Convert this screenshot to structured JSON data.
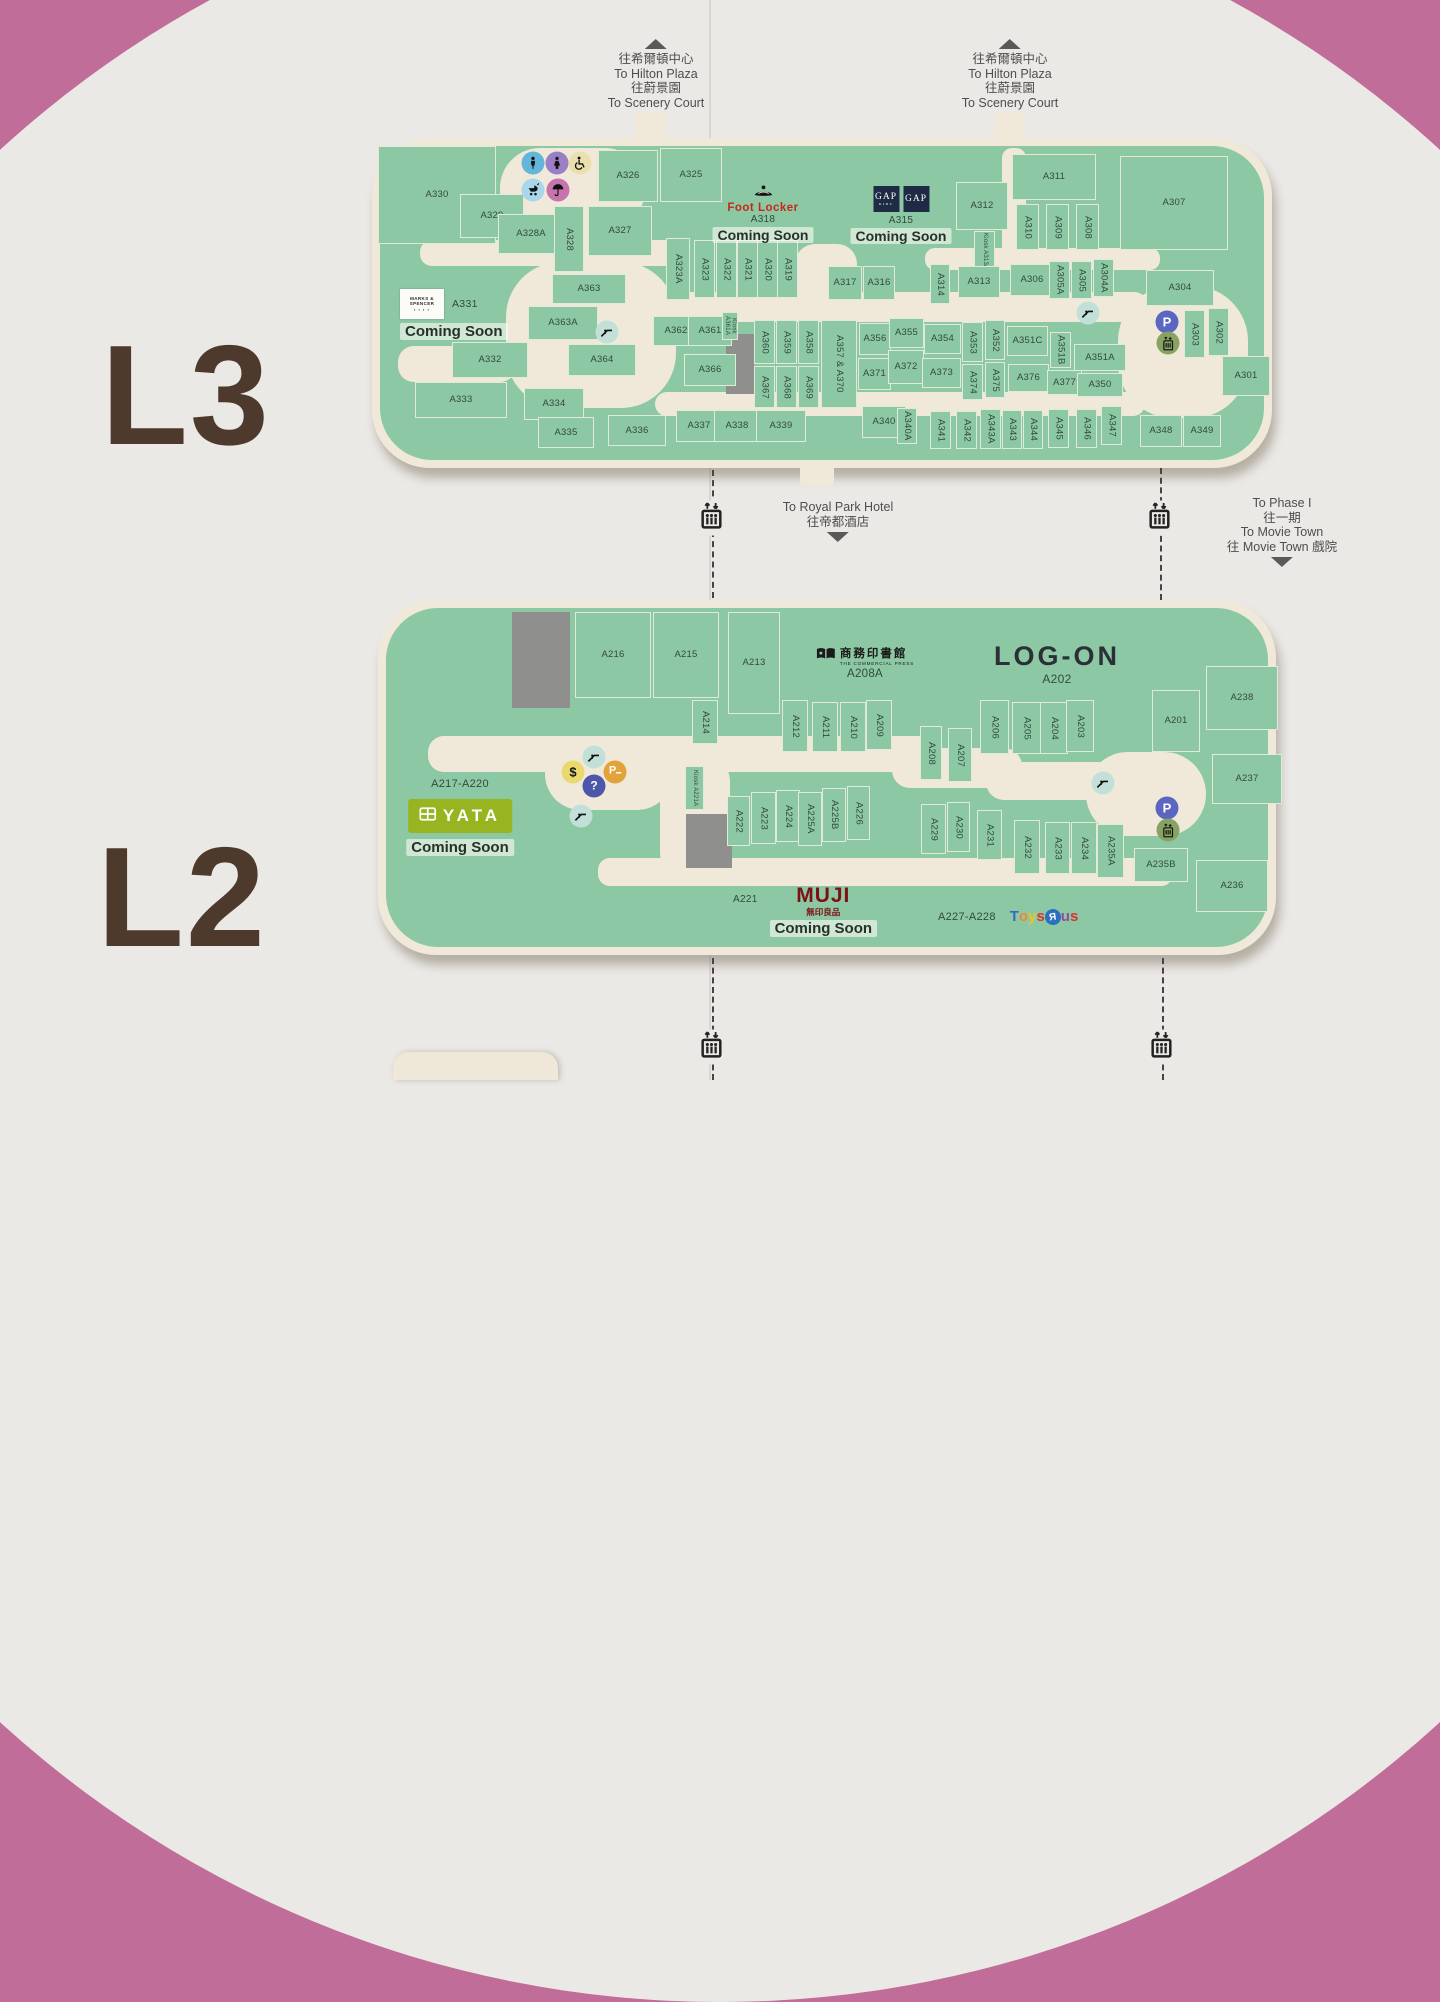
{
  "colors": {
    "pink": "#c16d99",
    "panel": "#ebe9e6",
    "map_base": "#f0e9da",
    "map_green": "#8dc8a4",
    "gray_block": "#8f8f8d",
    "floor_letter": "#4e3a2c",
    "unit_text": "#31493c"
  },
  "icon_colors": {
    "toilet-male": "#64b6d9",
    "toilet-female": "#9a7fc6",
    "accessible": "#ecdfae",
    "stroller": "#a9d6ea",
    "nursing": "#c673ae",
    "escalator": "#c2e0d8",
    "parking": "#5a66bf",
    "lift": "#87a262",
    "dollar": "#e9d96f",
    "meter": "#e2a33b",
    "info": "#4d57a9"
  },
  "floor_labels": [
    {
      "text": "L3",
      "x": 186,
      "y": 396
    },
    {
      "text": "L2",
      "x": 182,
      "y": 898
    }
  ],
  "signs": [
    {
      "id": "hilton-plaza-left",
      "x": 656,
      "y": 36,
      "dir": "up",
      "lines": [
        "往希爾頓中心",
        "To Hilton Plaza",
        "往蔚景園",
        "To Scenery Court"
      ]
    },
    {
      "id": "hilton-plaza-right",
      "x": 1010,
      "y": 36,
      "dir": "up",
      "lines": [
        "往希爾頓中心",
        "To Hilton Plaza",
        "往蔚景園",
        "To Scenery Court"
      ]
    },
    {
      "id": "royal-park-hotel",
      "x": 838,
      "y": 500,
      "dir": "down",
      "lines": [
        "To Royal Park Hotel",
        "往帝都酒店"
      ]
    },
    {
      "id": "phase1-movie-town",
      "x": 1282,
      "y": 496,
      "dir": "down",
      "lines": [
        "To Phase I",
        "往一期",
        "To Movie Town",
        "往 Movie Town 戲院"
      ]
    }
  ],
  "connectors": {
    "dashes": [
      [
        712,
        470,
        128
      ],
      [
        1160,
        468,
        132
      ],
      [
        712,
        958,
        122
      ],
      [
        1162,
        958,
        122
      ]
    ],
    "lifts": [
      [
        712,
        518
      ],
      [
        1160,
        518
      ],
      [
        712,
        1047
      ],
      [
        1162,
        1047
      ]
    ]
  },
  "stub": {
    "x": 393,
    "y": 1052,
    "w": 165,
    "h": 28
  },
  "floors": [
    {
      "id": "L3",
      "base": [
        372,
        138,
        900,
        330,
        58
      ],
      "tabs": [
        [
          636,
          112,
          30,
          46
        ],
        [
          994,
          112,
          30,
          46
        ],
        [
          800,
          440,
          34,
          46
        ]
      ],
      "walkways": [
        [
          500,
          148,
          145,
          82,
          40
        ],
        [
          545,
          200,
          48,
          110,
          20
        ],
        [
          506,
          262,
          170,
          146,
          55
        ],
        [
          618,
          292,
          530,
          30,
          14
        ],
        [
          655,
          392,
          490,
          24,
          12
        ],
        [
          1118,
          286,
          130,
          132,
          55
        ],
        [
          925,
          248,
          235,
          22,
          10
        ],
        [
          1002,
          148,
          24,
          112,
          10
        ],
        [
          795,
          244,
          62,
          76,
          20
        ],
        [
          420,
          240,
          260,
          26,
          12
        ],
        [
          398,
          346,
          118,
          36,
          16
        ]
      ],
      "grays": [
        [
          726,
          334,
          28,
          60
        ]
      ],
      "units": [
        [
          "A330",
          378,
          146,
          118,
          98
        ],
        [
          "A329",
          460,
          194,
          64,
          44
        ],
        [
          "A328A",
          498,
          214,
          66,
          40
        ],
        [
          "A328",
          554,
          206,
          30,
          66,
          "v"
        ],
        [
          "A327",
          588,
          206,
          64,
          50
        ],
        [
          "A326",
          598,
          150,
          60,
          52
        ],
        [
          "A325",
          660,
          148,
          62,
          54
        ],
        [
          "A323A",
          666,
          238,
          24,
          62,
          "v"
        ],
        [
          "A323",
          694,
          240,
          21,
          58,
          "v"
        ],
        [
          "A322",
          716,
          240,
          21,
          58,
          "v"
        ],
        [
          "A321",
          737,
          240,
          21,
          58,
          "v"
        ],
        [
          "A320",
          757,
          240,
          21,
          58,
          "v"
        ],
        [
          "A319",
          777,
          240,
          21,
          58,
          "v"
        ],
        [
          "A317",
          828,
          266,
          34,
          34
        ],
        [
          "A316",
          863,
          266,
          32,
          34
        ],
        [
          "A311",
          1012,
          154,
          84,
          46
        ],
        [
          "A312",
          956,
          182,
          52,
          48
        ],
        [
          "A310",
          1016,
          204,
          23,
          46,
          "v"
        ],
        [
          "A309",
          1046,
          204,
          23,
          46,
          "v"
        ],
        [
          "A308",
          1076,
          204,
          23,
          46,
          "v"
        ],
        [
          "A307",
          1120,
          156,
          108,
          94
        ],
        [
          "Kiosk A313A",
          974,
          231,
          21,
          40,
          "vs"
        ],
        [
          "A313",
          958,
          266,
          42,
          32
        ],
        [
          "A314",
          930,
          264,
          20,
          40,
          "v"
        ],
        [
          "A306",
          1010,
          264,
          44,
          32
        ],
        [
          "A305A",
          1049,
          261,
          21,
          38,
          "v"
        ],
        [
          "A305",
          1071,
          261,
          21,
          38,
          "v"
        ],
        [
          "A304A",
          1093,
          259,
          21,
          38,
          "v"
        ],
        [
          "A304",
          1146,
          270,
          68,
          36
        ],
        [
          "A303",
          1184,
          310,
          21,
          48,
          "v"
        ],
        [
          "A302",
          1208,
          308,
          21,
          48,
          "v"
        ],
        [
          "A301",
          1222,
          356,
          48,
          40
        ],
        [
          "A363",
          552,
          274,
          74,
          30
        ],
        [
          "A363A",
          528,
          306,
          70,
          34
        ],
        [
          "A364",
          568,
          344,
          68,
          32
        ],
        [
          "A332",
          452,
          342,
          76,
          36
        ],
        [
          "A333",
          415,
          382,
          92,
          36
        ],
        [
          "A334",
          524,
          388,
          60,
          32
        ],
        [
          "A335",
          538,
          417,
          56,
          31
        ],
        [
          "A336",
          608,
          415,
          58,
          31
        ],
        [
          "A362",
          653,
          316,
          46,
          30
        ],
        [
          "A361",
          688,
          316,
          44,
          30
        ],
        [
          "Kiosk A361A",
          722,
          312,
          16,
          28,
          "vs"
        ],
        [
          "A366",
          684,
          354,
          52,
          32
        ],
        [
          "A337",
          676,
          410,
          46,
          32
        ],
        [
          "A338",
          714,
          410,
          46,
          32
        ],
        [
          "A339",
          756,
          410,
          50,
          32
        ],
        [
          "A360",
          754,
          320,
          21,
          44,
          "v"
        ],
        [
          "A359",
          776,
          320,
          21,
          44,
          "v"
        ],
        [
          "A358",
          798,
          320,
          21,
          44,
          "v"
        ],
        [
          "A367",
          754,
          366,
          21,
          42,
          "v"
        ],
        [
          "A368",
          776,
          366,
          21,
          42,
          "v"
        ],
        [
          "A369",
          798,
          366,
          21,
          42,
          "v"
        ],
        [
          "A357 & A370",
          821,
          320,
          36,
          88,
          "v"
        ],
        [
          "A356",
          859,
          323,
          32,
          32
        ],
        [
          "A371",
          858,
          358,
          33,
          32
        ],
        [
          "A355",
          889,
          318,
          35,
          30
        ],
        [
          "A372",
          888,
          350,
          36,
          34
        ],
        [
          "A354",
          924,
          324,
          37,
          30
        ],
        [
          "A373",
          922,
          358,
          39,
          30
        ],
        [
          "A353",
          962,
          322,
          21,
          40,
          "v"
        ],
        [
          "A374",
          962,
          364,
          21,
          36,
          "v"
        ],
        [
          "A352",
          985,
          320,
          20,
          40,
          "v"
        ],
        [
          "A375",
          985,
          362,
          20,
          36,
          "v"
        ],
        [
          "A351C",
          1007,
          326,
          41,
          30
        ],
        [
          "A376",
          1008,
          364,
          41,
          28
        ],
        [
          "A351B",
          1050,
          332,
          21,
          36,
          "v"
        ],
        [
          "A377",
          1047,
          370,
          35,
          25
        ],
        [
          "A351A",
          1074,
          344,
          52,
          27
        ],
        [
          "A350",
          1077,
          373,
          46,
          24
        ],
        [
          "A340",
          862,
          406,
          44,
          32
        ],
        [
          "A340A",
          897,
          408,
          20,
          36,
          "v"
        ],
        [
          "A341",
          930,
          411,
          21,
          38,
          "v"
        ],
        [
          "A342",
          956,
          411,
          21,
          38,
          "v"
        ],
        [
          "A343A",
          980,
          409,
          21,
          40,
          "v"
        ],
        [
          "A343",
          1002,
          410,
          20,
          39,
          "v"
        ],
        [
          "A344",
          1023,
          410,
          20,
          39,
          "v"
        ],
        [
          "A345",
          1048,
          409,
          21,
          39,
          "v"
        ],
        [
          "A346",
          1076,
          409,
          21,
          39,
          "v"
        ],
        [
          "A347",
          1101,
          406,
          21,
          39,
          "v"
        ],
        [
          "A348",
          1140,
          415,
          42,
          32
        ],
        [
          "A349",
          1183,
          415,
          38,
          32
        ]
      ],
      "icons": [
        [
          "toilet-male",
          533,
          163
        ],
        [
          "toilet-female",
          557,
          163
        ],
        [
          "accessible",
          580,
          163
        ],
        [
          "stroller",
          533,
          190
        ],
        [
          "nursing",
          558,
          190
        ],
        [
          "escalator",
          607,
          332
        ],
        [
          "escalator",
          1088,
          313
        ],
        [
          "parking",
          1167,
          322
        ],
        [
          "lift",
          1168,
          343
        ]
      ]
    },
    {
      "id": "L2",
      "base": [
        378,
        600,
        898,
        355,
        58
      ],
      "tabs": [],
      "walkways": [
        [
          428,
          736,
          510,
          36,
          16
        ],
        [
          545,
          738,
          128,
          72,
          36
        ],
        [
          660,
          752,
          70,
          130,
          30
        ],
        [
          892,
          748,
          130,
          40,
          18
        ],
        [
          986,
          762,
          130,
          38,
          18
        ],
        [
          1086,
          752,
          120,
          84,
          42
        ],
        [
          598,
          858,
          575,
          28,
          12
        ]
      ],
      "grays": [
        [
          512,
          612,
          58,
          96
        ],
        [
          686,
          814,
          46,
          54
        ]
      ],
      "units": [
        [
          "A216",
          575,
          612,
          76,
          86
        ],
        [
          "A215",
          653,
          612,
          66,
          86
        ],
        [
          "A214",
          692,
          700,
          26,
          44,
          "v"
        ],
        [
          "A213",
          728,
          612,
          52,
          102
        ],
        [
          "A212",
          782,
          700,
          26,
          52,
          "v"
        ],
        [
          "A211",
          812,
          702,
          26,
          50,
          "v"
        ],
        [
          "A210",
          840,
          702,
          26,
          50,
          "v"
        ],
        [
          "A209",
          866,
          700,
          26,
          50,
          "v"
        ],
        [
          "A208",
          920,
          726,
          22,
          54,
          "v"
        ],
        [
          "A207",
          948,
          728,
          24,
          54,
          "v"
        ],
        [
          "A206",
          980,
          700,
          29,
          54,
          "v"
        ],
        [
          "A205",
          1012,
          702,
          29,
          52,
          "v"
        ],
        [
          "A204",
          1040,
          702,
          28,
          52,
          "v"
        ],
        [
          "A203",
          1066,
          700,
          28,
          52,
          "v"
        ],
        [
          "A201",
          1152,
          690,
          48,
          62
        ],
        [
          "A238",
          1206,
          666,
          72,
          64
        ],
        [
          "A237",
          1212,
          754,
          70,
          50
        ],
        [
          "Kiosk A221A",
          685,
          766,
          19,
          44,
          "vs"
        ],
        [
          "A222",
          727,
          796,
          23,
          50,
          "v"
        ],
        [
          "A223",
          751,
          792,
          25,
          52,
          "v"
        ],
        [
          "A224",
          776,
          790,
          24,
          52,
          "v"
        ],
        [
          "A225A",
          798,
          792,
          24,
          54,
          "v"
        ],
        [
          "A225B",
          822,
          788,
          24,
          54,
          "v"
        ],
        [
          "A226",
          847,
          786,
          23,
          54,
          "v"
        ],
        [
          "A229",
          921,
          804,
          25,
          50,
          "v"
        ],
        [
          "A230",
          947,
          802,
          23,
          50,
          "v"
        ],
        [
          "A231",
          977,
          810,
          25,
          50,
          "v"
        ],
        [
          "A232",
          1014,
          820,
          26,
          54,
          "v"
        ],
        [
          "A233",
          1045,
          822,
          25,
          52,
          "v"
        ],
        [
          "A234",
          1071,
          822,
          26,
          52,
          "v"
        ],
        [
          "A235A",
          1097,
          824,
          27,
          54,
          "v"
        ],
        [
          "A235B",
          1134,
          848,
          54,
          34
        ],
        [
          "A236",
          1196,
          860,
          72,
          52
        ]
      ],
      "icons": [
        [
          "escalator",
          594,
          757
        ],
        [
          "dollar",
          573,
          772
        ],
        [
          "meter",
          615,
          772
        ],
        [
          "info",
          594,
          786
        ],
        [
          "escalator",
          581,
          816
        ],
        [
          "escalator",
          1103,
          783
        ],
        [
          "parking",
          1167,
          808
        ],
        [
          "lift",
          1168,
          830
        ]
      ]
    }
  ],
  "brands": {
    "foot_locker": {
      "name": "Foot Locker",
      "unit": "A318",
      "status": "Coming Soon"
    },
    "gap": {
      "name": "GAP",
      "sub": "KIDS",
      "name2": "GAP",
      "unit": "A315",
      "status": "Coming Soon"
    },
    "marks_spencer": {
      "line1": "MARKS &",
      "line2": "SPENCER",
      "dots": "▪ ▪ ▪ ▪",
      "unit": "A331",
      "status": "Coming Soon"
    },
    "commercial_press": {
      "cn": "商務印書館",
      "en": "THE COMMERCIAL PRESS",
      "unit": "A208A"
    },
    "log_on": {
      "name": "LOG-ON",
      "unit": "A202"
    },
    "yata": {
      "range": "A217-A220",
      "name": "YATA",
      "status": "Coming Soon"
    },
    "muji": {
      "unit": "A221",
      "name": "MUJI",
      "cn": "無印良品",
      "status": "Coming Soon"
    },
    "toysrus": {
      "range": "A227-A228",
      "letters": [
        [
          "T",
          "#2b6fc0"
        ],
        [
          "o",
          "#f1862c"
        ],
        [
          "y",
          "#f0c51c"
        ],
        [
          "s",
          "#d7352c"
        ],
        [
          "R",
          "#2b6fc0",
          "star"
        ],
        [
          "u",
          "#8a4fa0"
        ],
        [
          "s",
          "#d7352c"
        ]
      ]
    }
  }
}
